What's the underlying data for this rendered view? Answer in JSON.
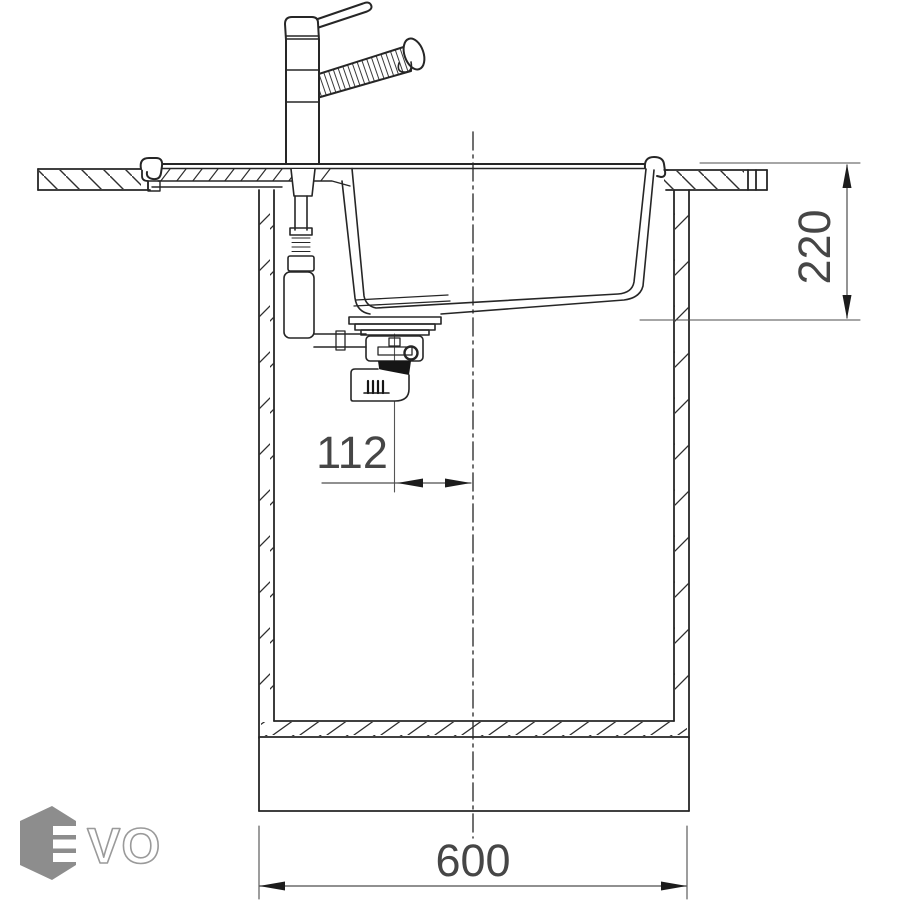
{
  "drawing": {
    "type": "sink-installation-cross-section",
    "dimensions": {
      "bowl_depth": {
        "value": "220",
        "orientation": "vertical",
        "side": "right"
      },
      "drain_offset_from_center": {
        "value": "112",
        "orientation": "horizontal"
      },
      "cabinet_width": {
        "value": "600",
        "orientation": "horizontal",
        "side": "bottom"
      }
    },
    "logo": {
      "brand": "EVO",
      "outline_letters": "VO",
      "hex_color": "#8d8d8d"
    },
    "colors": {
      "line": "#262626",
      "thin_line": "#4d4d4d",
      "dimension_text": "#464646",
      "black_fitting": "#161616",
      "background": "#ffffff"
    }
  }
}
